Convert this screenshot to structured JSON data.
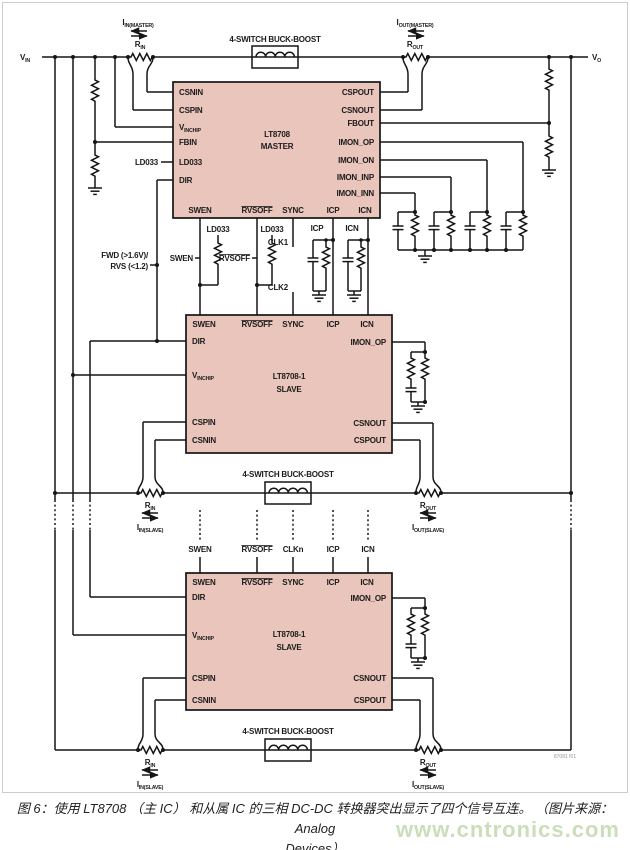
{
  "rails": {
    "v": "V",
    "vin_sub": "IN",
    "vo_sub": "O"
  },
  "converter": {
    "buck_boost_label": "4-SWITCH BUCK-BOOST"
  },
  "sense": {
    "i": "I",
    "r": "R",
    "rin_sub": "IN",
    "rout_sub": "OUT",
    "iin_master_sub": "IN(MASTER)",
    "iout_master_sub": "OUT(MASTER)",
    "iin_slave_sub": "IN(SLAVE)",
    "iout_slave_sub": "OUT(SLAVE)"
  },
  "chips": {
    "master": {
      "name": "LT8708",
      "role": "MASTER"
    },
    "slave": {
      "name": "LT8708-1",
      "role": "SLAVE"
    }
  },
  "pins": {
    "csnin": "CSNIN",
    "cspin": "CSPIN",
    "v": "V",
    "vinchip_sub": "INCHIP",
    "fbin": "FBIN",
    "ld033": "LD033",
    "dir": "DIR",
    "swen": "SWEN",
    "rvsoff": "RVSOFF",
    "sync": "SYNC",
    "icp": "ICP",
    "icn": "ICN",
    "cspout": "CSPOUT",
    "csnout": "CSNOUT",
    "fbout": "FBOUT",
    "imon_op": "IMON_OP",
    "imon_on": "IMON_ON",
    "imon_inp": "IMON_INP",
    "imon_inn": "IMON_INN"
  },
  "nets": {
    "ld033": "LD033",
    "swen": "SWEN",
    "rvsoff": "RVSOFF",
    "clk1": "CLK1",
    "clk2": "CLK2",
    "clkn": "CLKn",
    "icp": "ICP",
    "icn": "ICN",
    "fwd_line1": "FWD (>1.6V)/",
    "fwd_line2": "RVS (<1.2)"
  },
  "fig_ref": "87081 f01",
  "caption": {
    "line1": "图 6：使用 LT8708 （主 IC） 和从属 IC 的三相 DC-DC 转换器突出显示了四个信号互连。 （图片来源：Analog",
    "line2": "Devices）"
  },
  "watermark": "www.cntronics.com",
  "colors": {
    "chip_fill": "#e9c5bb",
    "wire": "#151515",
    "watermark": "#bdd6a9",
    "frame": "#cccccc",
    "caption": "#222222"
  }
}
